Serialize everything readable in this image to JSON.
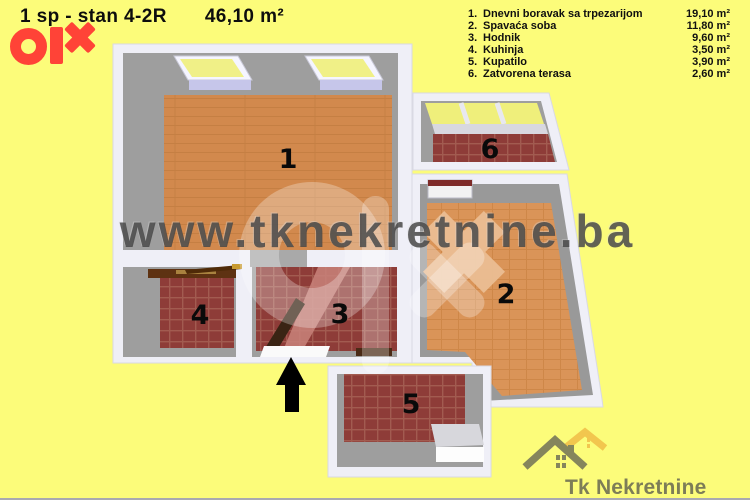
{
  "header": {
    "title": "1 sp - stan 4-2R",
    "area": "46,10 m²"
  },
  "legend": {
    "items": [
      {
        "num": "1.",
        "label": "Dnevni boravak sa trpezarijom",
        "area": "19,10 m²"
      },
      {
        "num": "2.",
        "label": "Spavaća soba",
        "area": "11,80 m²"
      },
      {
        "num": "3.",
        "label": "Hodnik",
        "area": "9,60 m²"
      },
      {
        "num": "4.",
        "label": "Kuhinja",
        "area": "3,50 m²"
      },
      {
        "num": "5.",
        "label": "Kupatilo",
        "area": "3,90 m²"
      },
      {
        "num": "6.",
        "label": "Zatvorena terasa",
        "area": "2,60 m²"
      }
    ]
  },
  "floorplan": {
    "rooms": [
      {
        "number": "1"
      },
      {
        "number": "2"
      },
      {
        "number": "3"
      },
      {
        "number": "4"
      },
      {
        "number": "5"
      },
      {
        "number": "6"
      }
    ]
  },
  "watermark": {
    "text": "www.tknekretnine.ba"
  },
  "brand": {
    "olx": "olx",
    "footer": "Tk Nekretnine"
  },
  "colors": {
    "background": "#FCFC7A",
    "olx_red": "#FF4337",
    "wall_white": "#EFEFF7",
    "inner_wall_gray": "#9E9E9E",
    "floor_orange": "#D2894D",
    "floor_orange_room2": "#DA9458",
    "tile_red": "#8E3C38",
    "window_glass_yellow": "#EFEF7B",
    "window_sill_lavender": "#C6C6EA",
    "watermark_gray": "#464646",
    "tk_olive": "#85855C",
    "tk_gold": "#F2C64E",
    "arrow_black": "#000000"
  }
}
